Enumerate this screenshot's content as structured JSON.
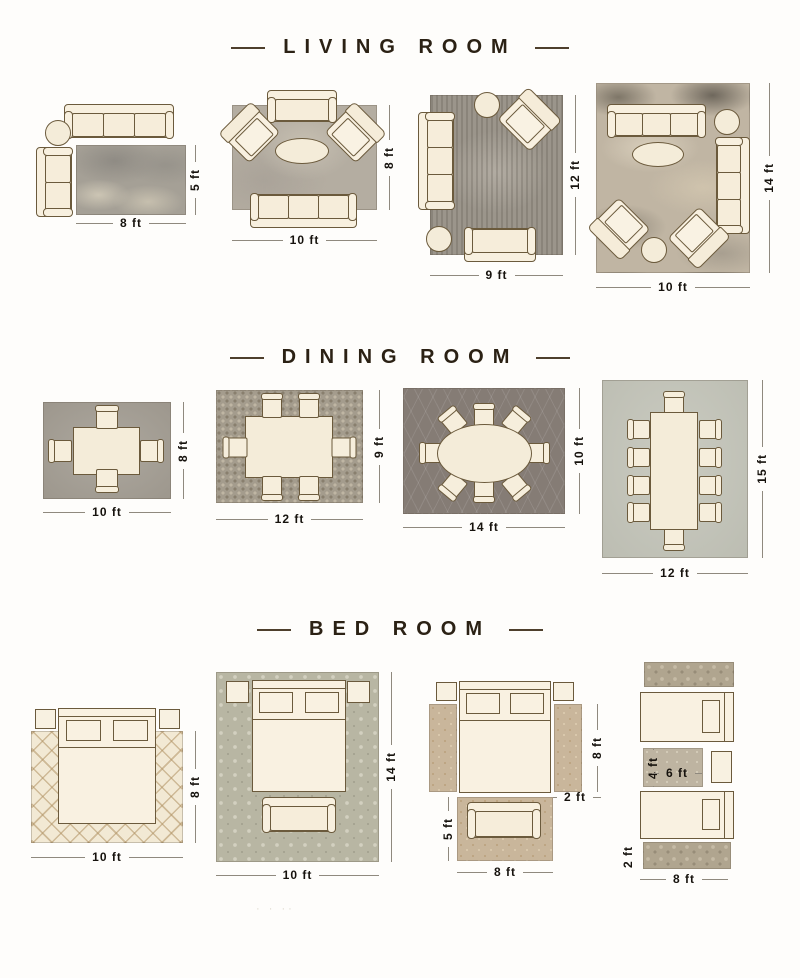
{
  "colors": {
    "header_text": "#2b2114",
    "header_rule": "#4e3f2c",
    "dimension_text": "#16120d",
    "dimension_line": "#8f897e",
    "furniture_fill": "#f8f0df",
    "furniture_outline": "#6b5a3c",
    "rug_gray": "#a5a096",
    "rug_taupe": "#b4ada1",
    "rug_dark_gray": "#857c75",
    "rug_sage": "#b8b6a3",
    "rug_cream": "#f2e9d4",
    "rug_tan": "#c9b69b"
  },
  "watermark": "· · ··",
  "sections": [
    {
      "id": "living-room",
      "title": "LIVING ROOM",
      "layouts": [
        {
          "width": "8 ft",
          "height": "5 ft"
        },
        {
          "width": "10 ft",
          "height": "8 ft"
        },
        {
          "width": "9 ft",
          "height": "12 ft"
        },
        {
          "width": "10 ft",
          "height": "14 ft"
        }
      ]
    },
    {
      "id": "dining-room",
      "title": "DINING ROOM",
      "layouts": [
        {
          "width": "10 ft",
          "height": "8 ft"
        },
        {
          "width": "12 ft",
          "height": "9 ft"
        },
        {
          "width": "14 ft",
          "height": "10 ft"
        },
        {
          "width": "12 ft",
          "height": "15 ft"
        }
      ]
    },
    {
      "id": "bed-room",
      "title": "BED ROOM",
      "layouts": [
        {
          "width": "10 ft",
          "height": "8 ft"
        },
        {
          "width": "10 ft",
          "height": "14 ft"
        },
        {
          "runner_length": "8 ft",
          "runner_width": "2 ft",
          "foot_rug_height": "5 ft",
          "foot_rug_width": "8 ft"
        },
        {
          "mid_rug_height": "4 ft",
          "mid_rug_width": "6 ft",
          "runner_height": "2 ft",
          "width": "8 ft"
        }
      ]
    }
  ]
}
